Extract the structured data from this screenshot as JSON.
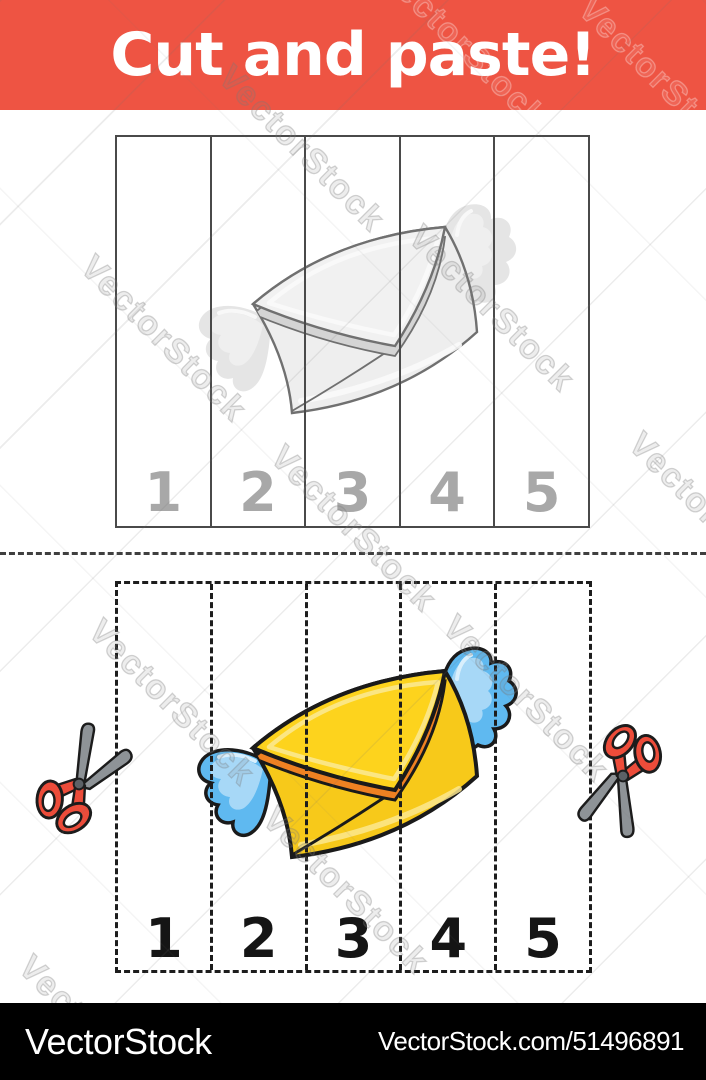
{
  "banner": {
    "title": "Cut and paste!"
  },
  "puzzle": {
    "top_numbers": [
      "1",
      "2",
      "3",
      "4",
      "5"
    ],
    "bottom_numbers": [
      "1",
      "2",
      "3",
      "4",
      "5"
    ]
  },
  "watermark": {
    "text": "VectorStock"
  },
  "footer": {
    "brand": "VectorStock",
    "credit": "VectorStock.com/51496891"
  },
  "icons": {
    "scissors_left": "scissors-icon",
    "scissors_right": "scissors-icon",
    "top_illustration": "winged-envelope-grayscale",
    "bottom_illustration": "winged-envelope-color"
  },
  "colors": {
    "banner_red": "#ee5443",
    "number_gray": "#a8a8a8",
    "number_black": "#151515",
    "line_dark": "#4a4a4a",
    "dash_black": "#1d1d1d",
    "sep_dash": "#3f3f3f",
    "footer_bg": "#000000",
    "footer_text": "#ffffff",
    "env_yellow_flap": "#fdd31d",
    "env_yellow_body": "#f7c91a",
    "env_orange": "#ef8122",
    "env_pale": "#fbe88f",
    "env_outline": "#1a1a1a",
    "wing_blue": "#5fb9f0",
    "wing_blue_light": "#a7d8f7",
    "wing_gloss": "#d9effc",
    "gray_body": "#eeeeee",
    "gray_flap": "#f1f1f1",
    "gray_under": "#d4d4d4",
    "gray_pale": "#fafafa",
    "gray_outline": "#707070",
    "gray_wing": "#e5e5e5",
    "gray_wing_light": "#efefef",
    "gray_wing_gloss": "#f8f8f8",
    "scissors_red": "#ec4c3a",
    "scissors_blade": "#8e9397",
    "scissors_outline": "#1c1c1c"
  }
}
